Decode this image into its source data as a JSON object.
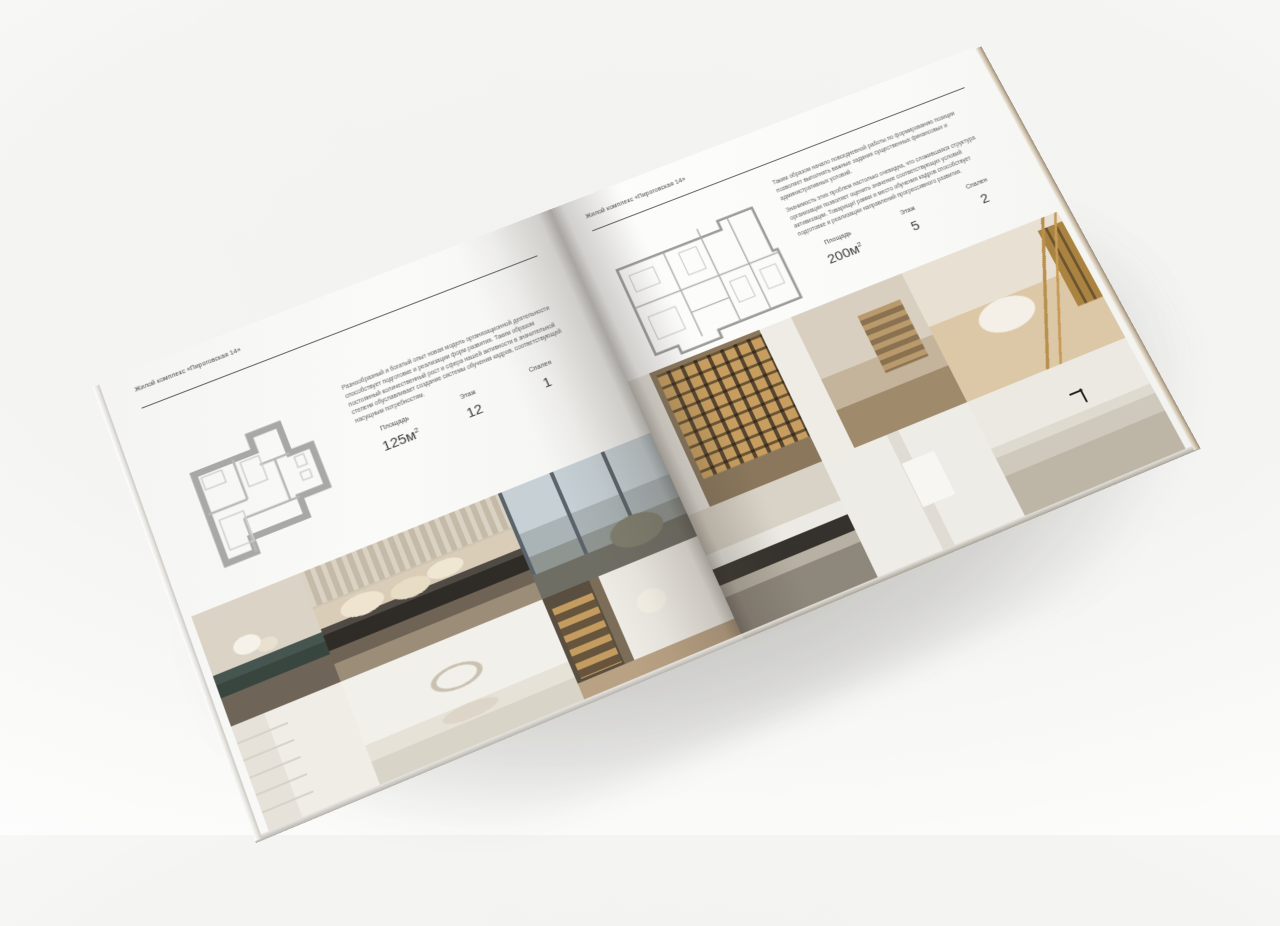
{
  "colors": {
    "background_top": "#f2f2f0",
    "background_bottom": "#ffffff",
    "paper": "#fafaf8",
    "rule": "#4c4c4c",
    "text": "#3b3b3b",
    "muted_text": "#5e5e5e"
  },
  "pages": [
    {
      "header": "Жилой комплекс «Пироговская 14»",
      "paragraphs": [
        "Разнообразный и богатый опыт новая модель организационной деятельности способствует подготовке и реализации форм развития. Таким образом постоянный количественный рост и сфера нашей активности в значительной степени обуславливает создание системы обучения кадров, соответствующей насущным потребностям."
      ],
      "stats": [
        {
          "label": "Площадь",
          "value": "125м",
          "sup": "2"
        },
        {
          "label": "Этаж",
          "value": "12"
        },
        {
          "label": "Спален",
          "value": "1"
        }
      ],
      "floor_plan": "apartment-plan-125",
      "photos": [
        "bedroom-dresser-flowers",
        "bedroom-bed",
        "window-lounge",
        "white-shelving",
        "bedroom-arch",
        "corridor-bookshelf"
      ]
    },
    {
      "header": "Жилой комплекс «Пироговская 14»",
      "paragraphs": [
        "Таким образом начало повседневной работы по формированию позиции позволяет выполнять важные задания существенных финансовых и административных условий.",
        "Значимость этих проблем настолько очевидна, что сложившаяся структура организации позволяет оценить значение соответствующих условий активизации. Товарищи! рамки и место обучения кадров способствует подготовке и реализации направлений прогрессивного развития."
      ],
      "stats": [
        {
          "label": "Площадь",
          "value": "200м",
          "sup": "2"
        },
        {
          "label": "Этаж",
          "value": "5"
        },
        {
          "label": "Спален",
          "value": "2"
        }
      ],
      "floor_plan": "apartment-plan-200",
      "photos": [
        "closet-lit-shelves",
        "hallway-office",
        "lounge-chaise",
        "kitchen-dark",
        "bathroom-towel",
        "bathroom-vanity"
      ]
    }
  ]
}
